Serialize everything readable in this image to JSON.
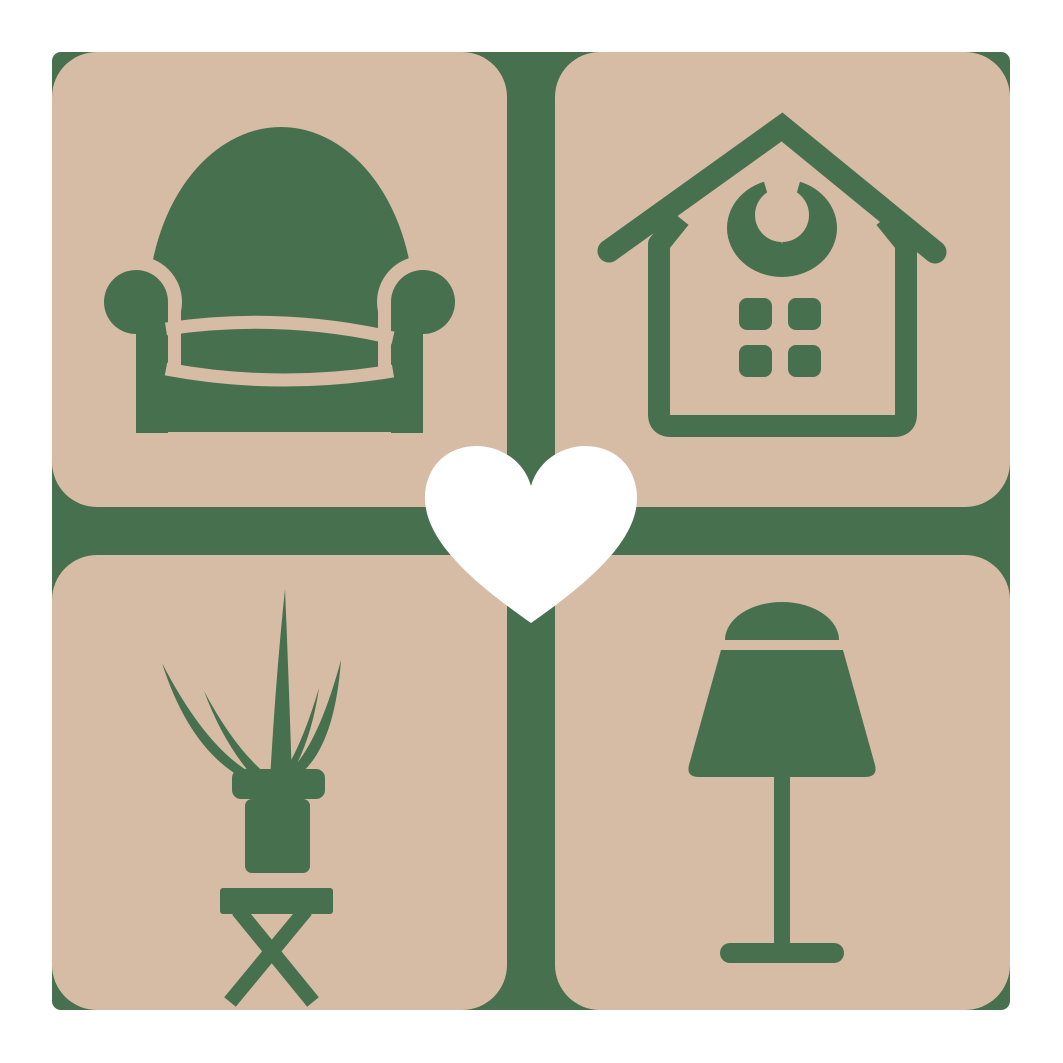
{
  "meta": {
    "type": "logo-graphic",
    "description": "Home decor and furniture logo: four rounded-corner tan tiles in a 2x2 grid separated by a green cross gap, each tile bearing a green furniture icon, with a white heart overlaying the center"
  },
  "palette": {
    "bg": "#ffffff",
    "tile": "#d6bca4",
    "green": "#47714e",
    "heart": "#ffffff"
  },
  "grid": {
    "rows": 2,
    "cols": 2,
    "tile_corner_radius_px": 45,
    "gap_px": 48,
    "content_origin_px": 52,
    "content_size_px": 958
  },
  "tiles": [
    {
      "id": "armchair",
      "position": "top-left",
      "icon": "armchair-icon"
    },
    {
      "id": "house",
      "position": "top-right",
      "icon": "house-icon"
    },
    {
      "id": "plant",
      "position": "bottom-left",
      "icon": "potted-plant-icon"
    },
    {
      "id": "lamp",
      "position": "bottom-right",
      "icon": "table-lamp-icon"
    }
  ],
  "center_overlay": {
    "icon": "heart-icon",
    "color": "#ffffff"
  }
}
